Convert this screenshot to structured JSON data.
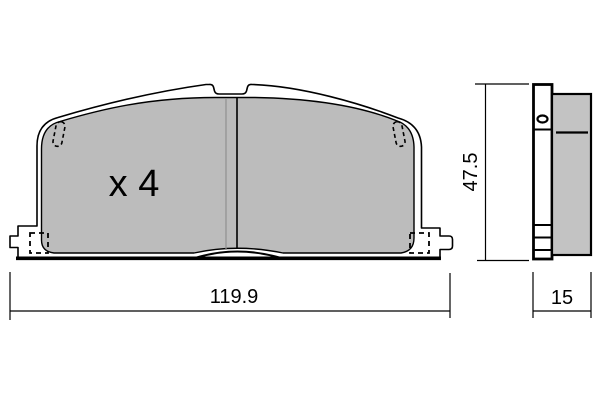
{
  "diagram": {
    "type": "technical-drawing",
    "subject": "brake-pad-set",
    "front_view": {
      "quantity_label": "x 4",
      "width_dimension": "119.9"
    },
    "side_view": {
      "height_dimension": "47.5",
      "thickness_dimension": "15"
    },
    "colors": {
      "pad_fill": "#bcbcbc",
      "side_pad_fill": "#c3c3c3",
      "outline": "#000000",
      "slot_shade_line": "#909090",
      "background": "#ffffff"
    }
  }
}
